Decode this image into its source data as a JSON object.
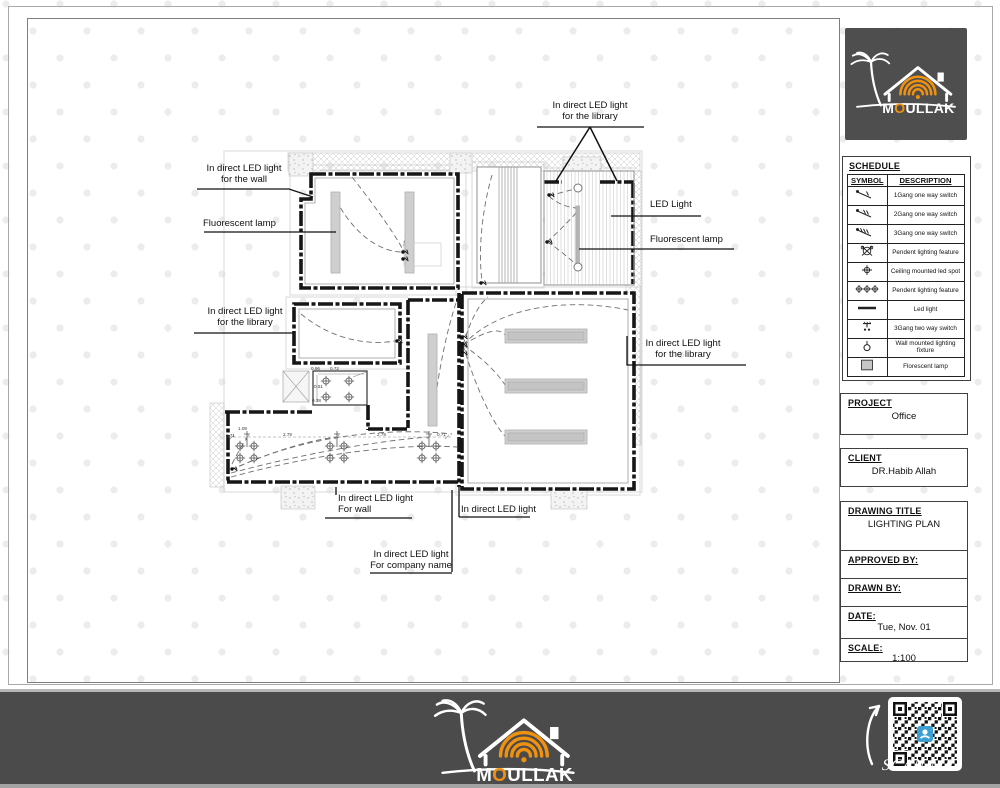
{
  "plan": {
    "labels": {
      "top_library_1": "In direct LED light",
      "top_library_2": "for the library",
      "wall_left_1": "In direct LED light",
      "wall_left_2": "for the wall",
      "fluorescent_left": "Fluorescent lamp",
      "led_light": "LED Light",
      "fluorescent_right": "Fluorescent lamp",
      "library_left_1": "In direct LED light",
      "library_left_2": "for the library",
      "library_right_1": "In direct LED light",
      "library_right_2": "for the library",
      "wall_bottom_1": "In direct LED light",
      "wall_bottom_2": "For wall",
      "led_bottom": "In direct LED light",
      "company_1": "In direct LED light",
      "company_2": "For company name"
    },
    "dims_room": [
      "0.96",
      "0.72",
      "0.51",
      "0.38"
    ],
    "dims_bottom": [
      "1.08",
      "0.71",
      "2.79",
      "2.79",
      "0.71"
    ]
  },
  "titleblock": {
    "schedule_heading": "SCHEDULE",
    "schedule_columns": {
      "symbol": "SYMBOL",
      "description": "DESCRIPTION"
    },
    "schedule_rows": [
      {
        "icon": "switch-1gang-icon",
        "description": "1Gang one way switch"
      },
      {
        "icon": "switch-2gang-icon",
        "description": "2Gang one way switch"
      },
      {
        "icon": "switch-3gang-icon",
        "description": "3Gang one way switch"
      },
      {
        "icon": "pendant-light-icon",
        "description": "Pendent lighting feature"
      },
      {
        "icon": "ceiling-spot-icon",
        "description": "Ceiling mounted led spot"
      },
      {
        "icon": "pendant-triple-icon",
        "description": "Pendent lighting feature"
      },
      {
        "icon": "led-light-icon",
        "description": "Led light"
      },
      {
        "icon": "switch-3gang-2way-icon",
        "description": "3Gang two way switch"
      },
      {
        "icon": "wall-light-icon",
        "description": "Wall mounted lighting fixture"
      },
      {
        "icon": "fluorescent-lamp-icon",
        "description": "Florescent lamp"
      }
    ],
    "project_label": "PROJECT",
    "project_value": "Office",
    "client_label": "CLIENT",
    "client_value": "DR.Habib Allah",
    "drawing_title_label": "DRAWING TITLE",
    "drawing_title_value": "LIGHTING PLAN",
    "approved_by_label": "APPROVED BY:",
    "drawn_by_label": "DRAWN BY:",
    "date_label": "DATE:",
    "date_value": "Tue, Nov. 01",
    "scale_label": "SCALE:",
    "scale_value": "1:100"
  },
  "brand": {
    "m": "M",
    "o": "O",
    "rest": "ULLAK",
    "scan_me": "SCAN ME"
  },
  "colors": {
    "accent_orange": "#F0920F",
    "panel_gray": "#4B4B4B",
    "qr_blue": "#3B9FD4"
  }
}
